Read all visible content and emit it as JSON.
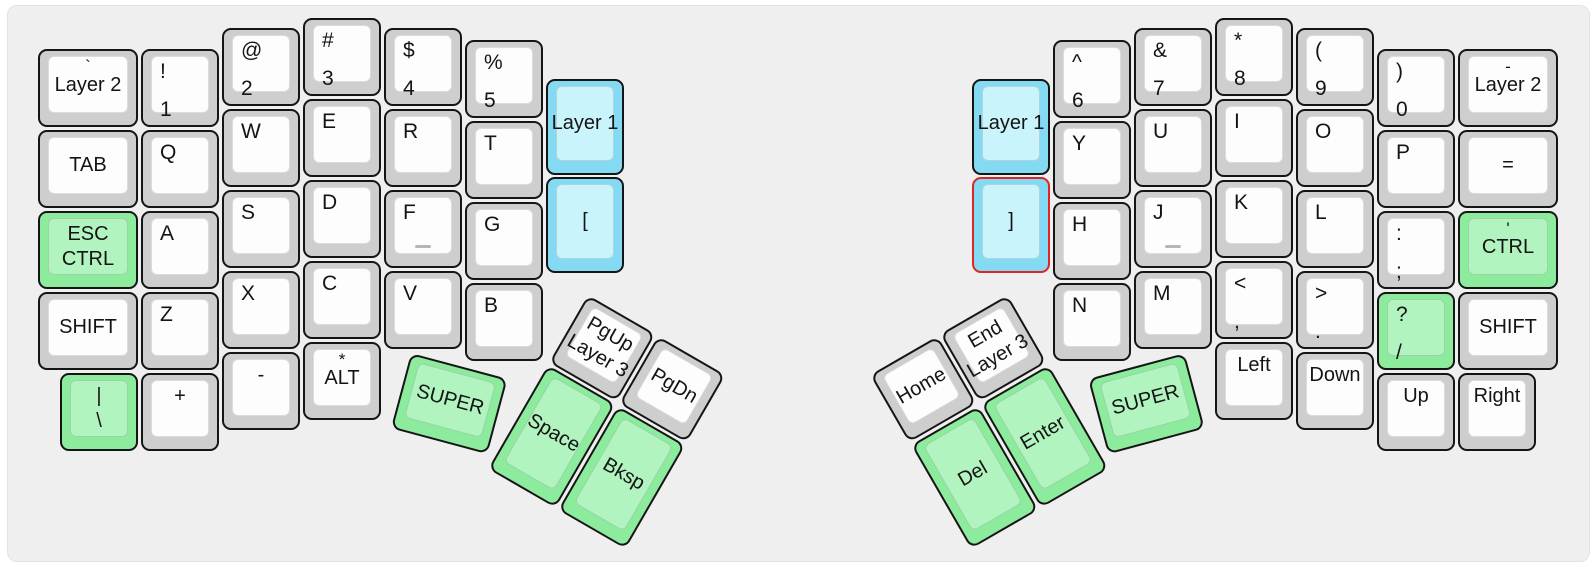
{
  "board": {
    "name": "split-ergo-keyboard-layout",
    "width": 1596,
    "height": 567,
    "colors": {
      "panel_bg": "#efefef",
      "gray_outer": "#cecece",
      "gray_inner": "#fdfdfd",
      "green_outer": "#8deb9e",
      "green_inner": "#b2f4c0",
      "blue_outer": "#84daf3",
      "blue_inner": "#c9f4fc",
      "key_border": "#151515",
      "red_border": "#e02424",
      "text": "#141414",
      "homing": "#b6b6b6"
    },
    "keys": [
      {
        "id": "grave-layer2",
        "x": 38,
        "y": 49,
        "w": 100,
        "h": 78,
        "rot": 0,
        "color": "gray",
        "style": "topc",
        "labels": [
          "`",
          "Layer 2"
        ]
      },
      {
        "id": "tab",
        "x": 38,
        "y": 130,
        "w": 100,
        "h": 78,
        "rot": 0,
        "color": "gray",
        "style": "center",
        "labels": [
          "TAB"
        ]
      },
      {
        "id": "esc-ctrl",
        "x": 38,
        "y": 211,
        "w": 100,
        "h": 78,
        "rot": 0,
        "color": "green",
        "style": "center",
        "labels": [
          "ESC",
          "CTRL"
        ]
      },
      {
        "id": "shift-left",
        "x": 38,
        "y": 292,
        "w": 100,
        "h": 78,
        "rot": 0,
        "color": "gray",
        "style": "center",
        "labels": [
          "SHIFT"
        ]
      },
      {
        "id": "pipe-backslash",
        "x": 60,
        "y": 373,
        "w": 78,
        "h": 78,
        "rot": 0,
        "color": "green",
        "style": "center",
        "labels": [
          "|",
          "\\"
        ]
      },
      {
        "id": "exclam-1",
        "x": 141,
        "y": 49,
        "w": 78,
        "h": 78,
        "rot": 0,
        "color": "gray",
        "style": "stack",
        "labels": [
          "!",
          "1"
        ]
      },
      {
        "id": "q",
        "x": 141,
        "y": 130,
        "w": 78,
        "h": 78,
        "rot": 0,
        "color": "gray",
        "style": "stack",
        "labels": [
          "Q"
        ]
      },
      {
        "id": "a",
        "x": 141,
        "y": 211,
        "w": 78,
        "h": 78,
        "rot": 0,
        "color": "gray",
        "style": "stack",
        "labels": [
          "A"
        ]
      },
      {
        "id": "z",
        "x": 141,
        "y": 292,
        "w": 78,
        "h": 78,
        "rot": 0,
        "color": "gray",
        "style": "stack",
        "labels": [
          "Z"
        ]
      },
      {
        "id": "plus",
        "x": 141,
        "y": 373,
        "w": 78,
        "h": 78,
        "rot": 0,
        "color": "gray",
        "style": "topsingle",
        "labels": [
          "+"
        ]
      },
      {
        "id": "at-2",
        "x": 222,
        "y": 28,
        "w": 78,
        "h": 78,
        "rot": 0,
        "color": "gray",
        "style": "stack",
        "labels": [
          "@",
          "2"
        ]
      },
      {
        "id": "w",
        "x": 222,
        "y": 109,
        "w": 78,
        "h": 78,
        "rot": 0,
        "color": "gray",
        "style": "stack",
        "labels": [
          "W"
        ]
      },
      {
        "id": "s",
        "x": 222,
        "y": 190,
        "w": 78,
        "h": 78,
        "rot": 0,
        "color": "gray",
        "style": "stack",
        "labels": [
          "S"
        ]
      },
      {
        "id": "x",
        "x": 222,
        "y": 271,
        "w": 78,
        "h": 78,
        "rot": 0,
        "color": "gray",
        "style": "stack",
        "labels": [
          "X"
        ]
      },
      {
        "id": "minus",
        "x": 222,
        "y": 352,
        "w": 78,
        "h": 78,
        "rot": 0,
        "color": "gray",
        "style": "topsingle",
        "labels": [
          "-"
        ]
      },
      {
        "id": "hash-3",
        "x": 303,
        "y": 18,
        "w": 78,
        "h": 78,
        "rot": 0,
        "color": "gray",
        "style": "stack",
        "labels": [
          "#",
          "3"
        ]
      },
      {
        "id": "e",
        "x": 303,
        "y": 99,
        "w": 78,
        "h": 78,
        "rot": 0,
        "color": "gray",
        "style": "stack",
        "labels": [
          "E"
        ]
      },
      {
        "id": "d",
        "x": 303,
        "y": 180,
        "w": 78,
        "h": 78,
        "rot": 0,
        "color": "gray",
        "style": "stack",
        "labels": [
          "D"
        ]
      },
      {
        "id": "c",
        "x": 303,
        "y": 261,
        "w": 78,
        "h": 78,
        "rot": 0,
        "color": "gray",
        "style": "stack",
        "labels": [
          "C"
        ]
      },
      {
        "id": "star-alt",
        "x": 303,
        "y": 342,
        "w": 78,
        "h": 78,
        "rot": 0,
        "color": "gray",
        "style": "topc",
        "labels": [
          "*",
          "ALT"
        ]
      },
      {
        "id": "dollar-4",
        "x": 384,
        "y": 28,
        "w": 78,
        "h": 78,
        "rot": 0,
        "color": "gray",
        "style": "stack",
        "labels": [
          "$",
          "4"
        ]
      },
      {
        "id": "r",
        "x": 384,
        "y": 109,
        "w": 78,
        "h": 78,
        "rot": 0,
        "color": "gray",
        "style": "stack",
        "labels": [
          "R"
        ]
      },
      {
        "id": "f",
        "x": 384,
        "y": 190,
        "w": 78,
        "h": 78,
        "rot": 0,
        "color": "gray",
        "style": "stack",
        "labels": [
          "F"
        ],
        "homing": true
      },
      {
        "id": "v",
        "x": 384,
        "y": 271,
        "w": 78,
        "h": 78,
        "rot": 0,
        "color": "gray",
        "style": "stack",
        "labels": [
          "V"
        ]
      },
      {
        "id": "percent-5",
        "x": 465,
        "y": 40,
        "w": 78,
        "h": 78,
        "rot": 0,
        "color": "gray",
        "style": "stack",
        "labels": [
          "%",
          "5"
        ]
      },
      {
        "id": "t",
        "x": 465,
        "y": 121,
        "w": 78,
        "h": 78,
        "rot": 0,
        "color": "gray",
        "style": "stack",
        "labels": [
          "T"
        ]
      },
      {
        "id": "g",
        "x": 465,
        "y": 202,
        "w": 78,
        "h": 78,
        "rot": 0,
        "color": "gray",
        "style": "stack",
        "labels": [
          "G"
        ]
      },
      {
        "id": "b",
        "x": 465,
        "y": 283,
        "w": 78,
        "h": 78,
        "rot": 0,
        "color": "gray",
        "style": "stack",
        "labels": [
          "B"
        ]
      },
      {
        "id": "layer1-left",
        "x": 546,
        "y": 79,
        "w": 78,
        "h": 96,
        "rot": 0,
        "color": "blue",
        "style": "center",
        "labels": [
          "Layer 1"
        ]
      },
      {
        "id": "lbracket",
        "x": 546,
        "y": 177,
        "w": 78,
        "h": 96,
        "rot": 0,
        "color": "blue",
        "style": "center",
        "labels": [
          "["
        ]
      },
      {
        "id": "super-left",
        "x": 411,
        "y": 353,
        "w": 100,
        "h": 78,
        "rot": 15,
        "color": "green",
        "style": "center",
        "labels": [
          "SUPER"
        ]
      },
      {
        "id": "pgup-layer3",
        "x": 588,
        "y": 295,
        "w": 78,
        "h": 78,
        "rot": 30,
        "color": "gray",
        "style": "center",
        "labels": [
          "PgUp",
          "Layer 3"
        ]
      },
      {
        "id": "pgdn",
        "x": 658,
        "y": 336,
        "w": 78,
        "h": 78,
        "rot": 30,
        "color": "gray",
        "style": "center",
        "labels": [
          "PgDn"
        ]
      },
      {
        "id": "space",
        "x": 548,
        "y": 365,
        "w": 78,
        "h": 120,
        "rot": 30,
        "color": "green",
        "style": "center",
        "labels": [
          "Space"
        ]
      },
      {
        "id": "bksp",
        "x": 618,
        "y": 406,
        "w": 78,
        "h": 120,
        "rot": 30,
        "color": "green",
        "style": "center",
        "labels": [
          "Bksp"
        ]
      },
      {
        "id": "layer1-right",
        "x": 972,
        "y": 79,
        "w": 78,
        "h": 96,
        "rot": 0,
        "color": "blue",
        "style": "center",
        "labels": [
          "Layer 1"
        ]
      },
      {
        "id": "rbracket",
        "x": 972,
        "y": 177,
        "w": 78,
        "h": 96,
        "rot": 0,
        "color": "blue",
        "style": "center",
        "labels": [
          "]"
        ],
        "border": "red"
      },
      {
        "id": "caret-6",
        "x": 1053,
        "y": 40,
        "w": 78,
        "h": 78,
        "rot": 0,
        "color": "gray",
        "style": "stack",
        "labels": [
          "^",
          "6"
        ]
      },
      {
        "id": "y",
        "x": 1053,
        "y": 121,
        "w": 78,
        "h": 78,
        "rot": 0,
        "color": "gray",
        "style": "stack",
        "labels": [
          "Y"
        ]
      },
      {
        "id": "h",
        "x": 1053,
        "y": 202,
        "w": 78,
        "h": 78,
        "rot": 0,
        "color": "gray",
        "style": "stack",
        "labels": [
          "H"
        ]
      },
      {
        "id": "n",
        "x": 1053,
        "y": 283,
        "w": 78,
        "h": 78,
        "rot": 0,
        "color": "gray",
        "style": "stack",
        "labels": [
          "N"
        ]
      },
      {
        "id": "amp-7",
        "x": 1134,
        "y": 28,
        "w": 78,
        "h": 78,
        "rot": 0,
        "color": "gray",
        "style": "stack",
        "labels": [
          "&",
          "7"
        ]
      },
      {
        "id": "u",
        "x": 1134,
        "y": 109,
        "w": 78,
        "h": 78,
        "rot": 0,
        "color": "gray",
        "style": "stack",
        "labels": [
          "U"
        ]
      },
      {
        "id": "j",
        "x": 1134,
        "y": 190,
        "w": 78,
        "h": 78,
        "rot": 0,
        "color": "gray",
        "style": "stack",
        "labels": [
          "J"
        ],
        "homing": true
      },
      {
        "id": "m",
        "x": 1134,
        "y": 271,
        "w": 78,
        "h": 78,
        "rot": 0,
        "color": "gray",
        "style": "stack",
        "labels": [
          "M"
        ]
      },
      {
        "id": "star-8",
        "x": 1215,
        "y": 18,
        "w": 78,
        "h": 78,
        "rot": 0,
        "color": "gray",
        "style": "stack",
        "labels": [
          "*",
          "8"
        ]
      },
      {
        "id": "i",
        "x": 1215,
        "y": 99,
        "w": 78,
        "h": 78,
        "rot": 0,
        "color": "gray",
        "style": "stack",
        "labels": [
          "I"
        ]
      },
      {
        "id": "k",
        "x": 1215,
        "y": 180,
        "w": 78,
        "h": 78,
        "rot": 0,
        "color": "gray",
        "style": "stack",
        "labels": [
          "K"
        ]
      },
      {
        "id": "lt-comma",
        "x": 1215,
        "y": 261,
        "w": 78,
        "h": 78,
        "rot": 0,
        "color": "gray",
        "style": "stack",
        "labels": [
          "<",
          ","
        ]
      },
      {
        "id": "arrow-left",
        "x": 1215,
        "y": 342,
        "w": 78,
        "h": 78,
        "rot": 0,
        "color": "gray",
        "style": "topsingle",
        "labels": [
          "Left"
        ]
      },
      {
        "id": "lparen-9",
        "x": 1296,
        "y": 28,
        "w": 78,
        "h": 78,
        "rot": 0,
        "color": "gray",
        "style": "stack",
        "labels": [
          "(",
          "9"
        ]
      },
      {
        "id": "o",
        "x": 1296,
        "y": 109,
        "w": 78,
        "h": 78,
        "rot": 0,
        "color": "gray",
        "style": "stack",
        "labels": [
          "O"
        ]
      },
      {
        "id": "l",
        "x": 1296,
        "y": 190,
        "w": 78,
        "h": 78,
        "rot": 0,
        "color": "gray",
        "style": "stack",
        "labels": [
          "L"
        ]
      },
      {
        "id": "gt-period",
        "x": 1296,
        "y": 271,
        "w": 78,
        "h": 78,
        "rot": 0,
        "color": "gray",
        "style": "stack",
        "labels": [
          ">",
          "."
        ]
      },
      {
        "id": "arrow-down",
        "x": 1296,
        "y": 352,
        "w": 78,
        "h": 78,
        "rot": 0,
        "color": "gray",
        "style": "topsingle",
        "labels": [
          "Down"
        ]
      },
      {
        "id": "rparen-0",
        "x": 1377,
        "y": 49,
        "w": 78,
        "h": 78,
        "rot": 0,
        "color": "gray",
        "style": "stack",
        "labels": [
          ")",
          "0"
        ]
      },
      {
        "id": "p",
        "x": 1377,
        "y": 130,
        "w": 78,
        "h": 78,
        "rot": 0,
        "color": "gray",
        "style": "stack",
        "labels": [
          "P"
        ]
      },
      {
        "id": "colon-semicolon",
        "x": 1377,
        "y": 211,
        "w": 78,
        "h": 78,
        "rot": 0,
        "color": "gray",
        "style": "stack",
        "labels": [
          ":",
          ";"
        ]
      },
      {
        "id": "question-slash",
        "x": 1377,
        "y": 292,
        "w": 78,
        "h": 78,
        "rot": 0,
        "color": "green",
        "style": "stack",
        "labels": [
          "?",
          "/"
        ]
      },
      {
        "id": "arrow-up",
        "x": 1377,
        "y": 373,
        "w": 78,
        "h": 78,
        "rot": 0,
        "color": "gray",
        "style": "topsingle",
        "labels": [
          "Up"
        ]
      },
      {
        "id": "dash-layer2",
        "x": 1458,
        "y": 49,
        "w": 100,
        "h": 78,
        "rot": 0,
        "color": "gray",
        "style": "topc",
        "labels": [
          "-",
          "Layer 2"
        ]
      },
      {
        "id": "equals",
        "x": 1458,
        "y": 130,
        "w": 100,
        "h": 78,
        "rot": 0,
        "color": "gray",
        "style": "center",
        "labels": [
          "="
        ]
      },
      {
        "id": "quote-ctrl",
        "x": 1458,
        "y": 211,
        "w": 100,
        "h": 78,
        "rot": 0,
        "color": "green",
        "style": "topc",
        "labels": [
          "'",
          "CTRL"
        ]
      },
      {
        "id": "shift-right",
        "x": 1458,
        "y": 292,
        "w": 100,
        "h": 78,
        "rot": 0,
        "color": "gray",
        "style": "center",
        "labels": [
          "SHIFT"
        ]
      },
      {
        "id": "arrow-right",
        "x": 1458,
        "y": 373,
        "w": 78,
        "h": 78,
        "rot": 0,
        "color": "gray",
        "style": "topsingle",
        "labels": [
          "Right"
        ]
      },
      {
        "id": "end-layer3",
        "x": 940,
        "y": 334,
        "w": 78,
        "h": 78,
        "rot": -30,
        "color": "gray",
        "style": "center",
        "labels": [
          "End",
          "Layer 3"
        ]
      },
      {
        "id": "home",
        "x": 870,
        "y": 375,
        "w": 78,
        "h": 78,
        "rot": -30,
        "color": "gray",
        "style": "center",
        "labels": [
          "Home"
        ]
      },
      {
        "id": "super-right",
        "x": 1088,
        "y": 379,
        "w": 100,
        "h": 78,
        "rot": -15,
        "color": "green",
        "style": "center",
        "labels": [
          "SUPER"
        ]
      },
      {
        "id": "enter",
        "x": 981,
        "y": 404,
        "w": 78,
        "h": 120,
        "rot": -30,
        "color": "green",
        "style": "center",
        "labels": [
          "Enter"
        ]
      },
      {
        "id": "del",
        "x": 911,
        "y": 445,
        "w": 78,
        "h": 120,
        "rot": -30,
        "color": "green",
        "style": "center",
        "labels": [
          "Del"
        ]
      }
    ]
  }
}
